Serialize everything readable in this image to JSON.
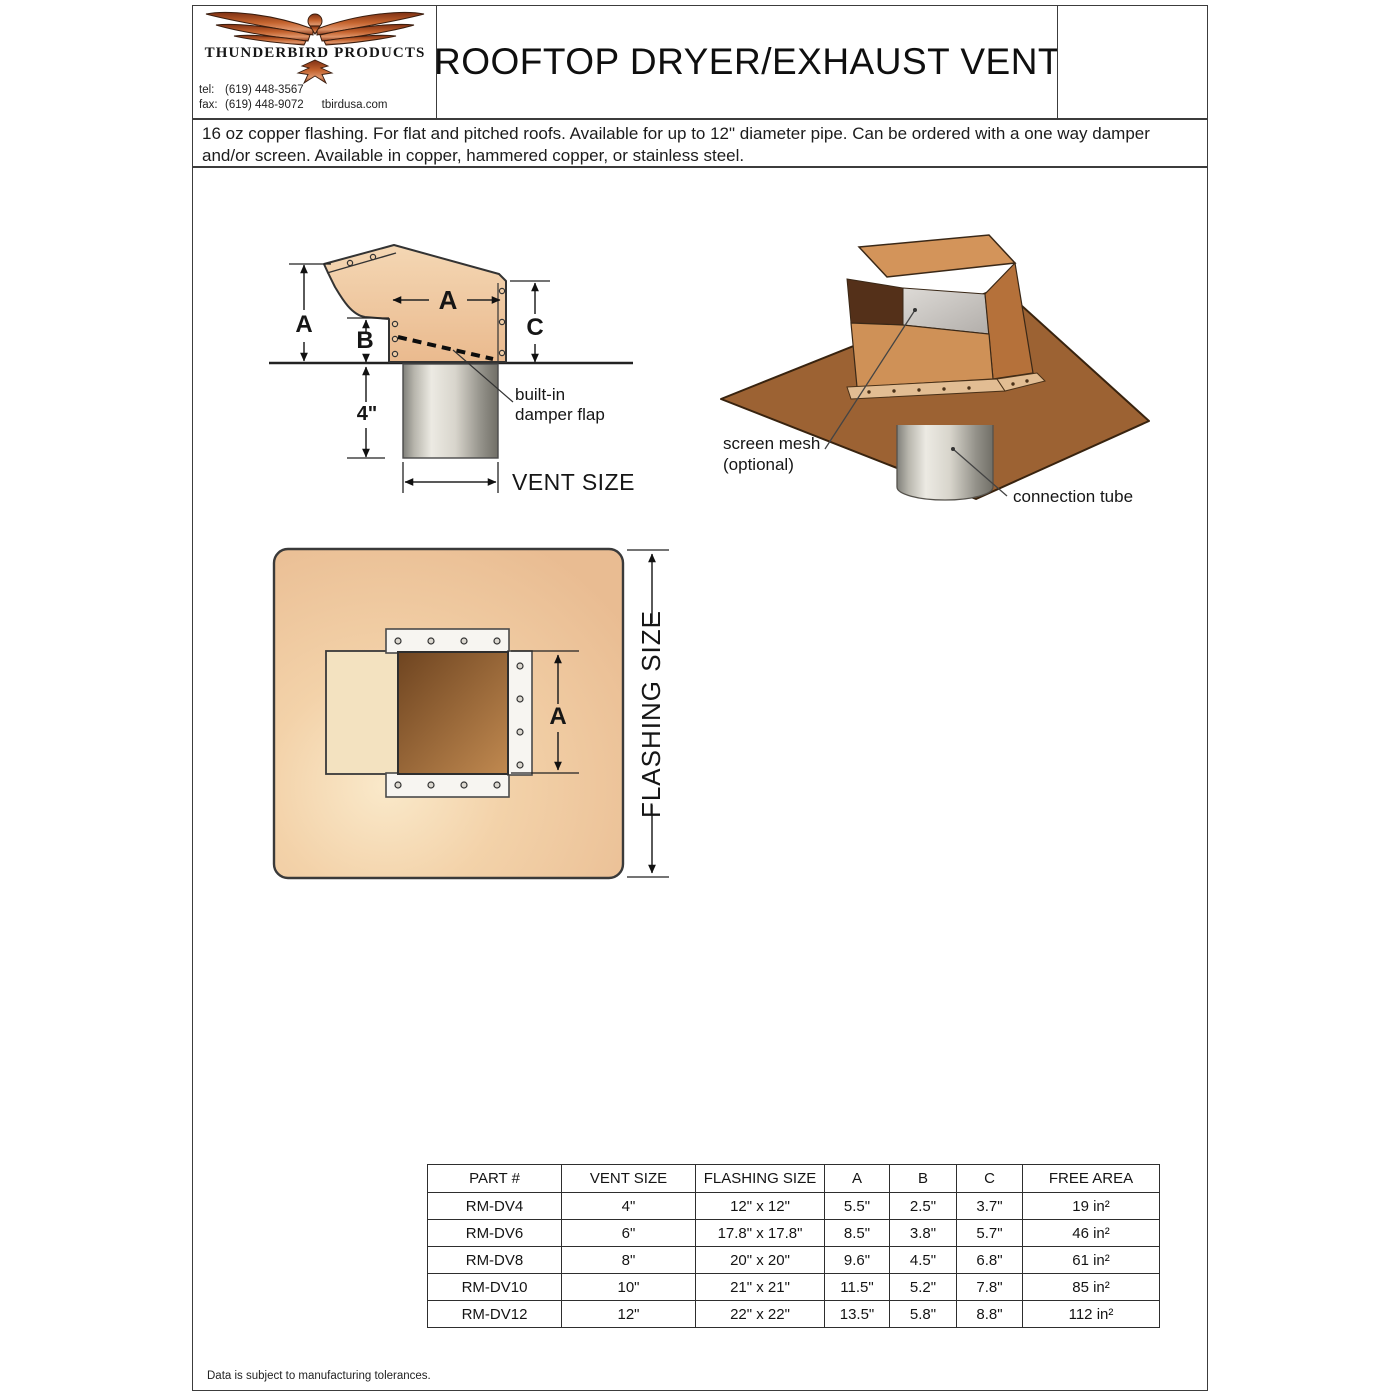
{
  "header": {
    "company": "THUNDERBIRD PRODUCTS",
    "tel_label": "tel:",
    "tel": "(619) 448-3567",
    "fax_label": "fax:",
    "fax": "(619) 448-9072",
    "website": "tbirdusa.com",
    "title": "ROOFTOP DRYER/EXHAUST VENT"
  },
  "description": {
    "text": "16 oz copper flashing. For flat and pitched roofs. Available for up to 12\" diameter pipe. Can be ordered with a one way damper and/or screen. Available in copper, hammered copper, or stainless steel."
  },
  "diagrams": {
    "side_view": {
      "dim_a_vertical": "A",
      "dim_a_horizontal": "A",
      "dim_b": "B",
      "dim_c": "C",
      "pipe_length": "4\"",
      "vent_size_label": "VENT SIZE",
      "damper_label_line1": "built-in",
      "damper_label_line2": "damper flap"
    },
    "iso_view": {
      "screen_mesh_line1": "screen mesh",
      "screen_mesh_line2": "(optional)",
      "connection_tube_label": "connection tube"
    },
    "top_view": {
      "dim_a": "A",
      "flashing_size_label": "FLASHING SIZE"
    }
  },
  "table": {
    "headers": [
      "PART #",
      "VENT SIZE",
      "FLASHING SIZE",
      "A",
      "B",
      "C",
      "FREE AREA"
    ],
    "rows": [
      [
        "RM-DV4",
        "4\"",
        "12\" x 12\"",
        "5.5\"",
        "2.5\"",
        "3.7\"",
        "19 in²"
      ],
      [
        "RM-DV6",
        "6\"",
        "17.8\" x 17.8\"",
        "8.5\"",
        "3.8\"",
        "5.7\"",
        "46 in²"
      ],
      [
        "RM-DV8",
        "8\"",
        "20\" x 20\"",
        "9.6\"",
        "4.5\"",
        "6.8\"",
        "61 in²"
      ],
      [
        "RM-DV10",
        "10\"",
        "21\" x 21\"",
        "11.5\"",
        "5.2\"",
        "7.8\"",
        "85 in²"
      ],
      [
        "RM-DV12",
        "12\"",
        "22\" x 22\"",
        "13.5\"",
        "5.8\"",
        "8.8\"",
        "112 in²"
      ]
    ]
  },
  "footer": {
    "note": "Data is subject to manufacturing tolerances."
  },
  "colors": {
    "copper_light": "#eec29c",
    "copper_mid": "#cf9157",
    "flashing_brown": "#9c6233",
    "logo_copper": "#c4632e",
    "line_dark": "#2e2e2e"
  }
}
